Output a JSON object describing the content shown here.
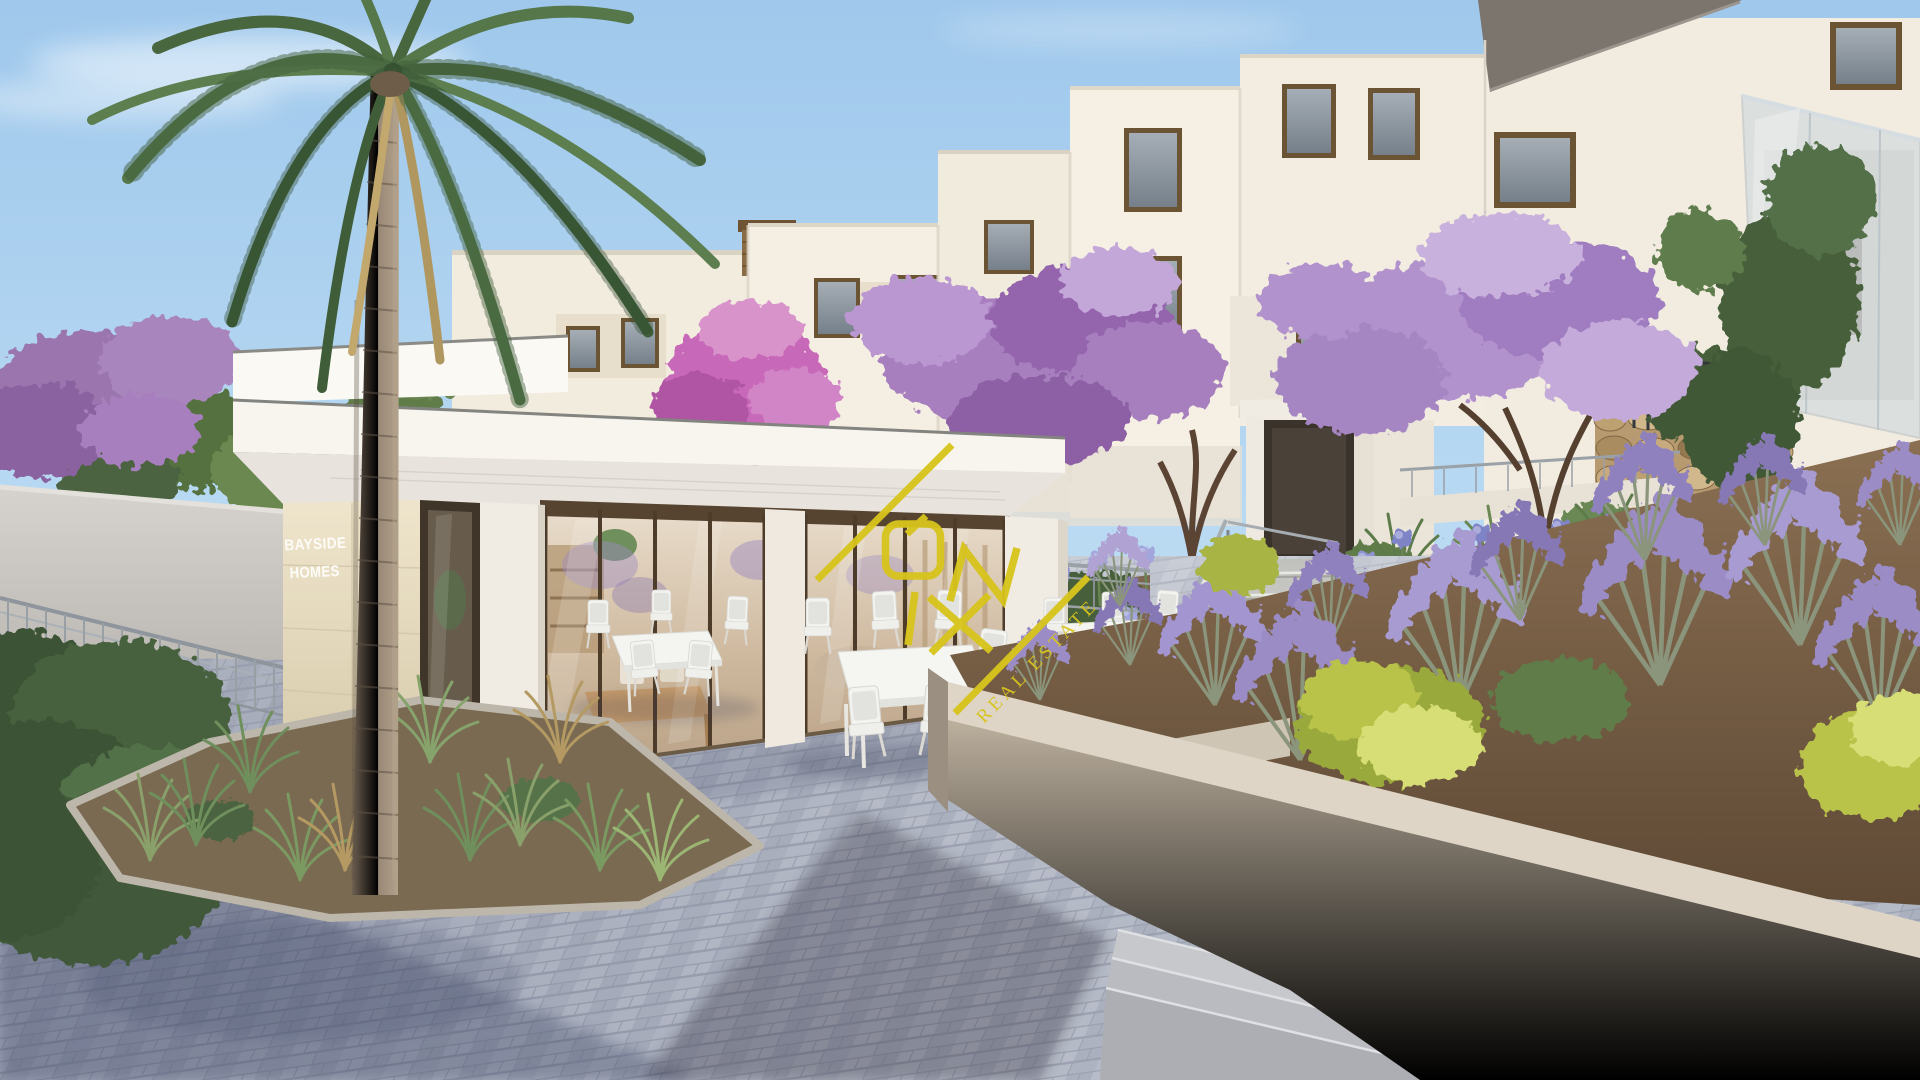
{
  "signage": {
    "line1": "BAYSIDE",
    "line2": "HOMES"
  },
  "watermark": {
    "brand": "ÓNIX",
    "tagline": "REAL ESTATE",
    "color": "#d7c41d"
  },
  "palette": {
    "sky_top": "#9fc8ec",
    "sky_horizon": "#d8ecf8",
    "building_sunlit": "#f6f0e4",
    "building_shade": "#e3dccf",
    "canopy_white": "#faf8f2",
    "sign_wall": "#e9dec3",
    "sign_text": "#fdfcf8",
    "window_frame": "#6b5433",
    "glass_door_frame": "#4e3c2a",
    "paving": "#aeb4c1",
    "paving_shadow": "#8b91a3",
    "planter_wall": "#b5a997",
    "soil": "#7d6750",
    "lavender": "#9b8cc6",
    "agapanthus": "#8f93d0",
    "jacaranda_purple": "#a77fbe",
    "magenta_tree": "#c867b8",
    "palm_green": "#55774a",
    "dry_frond": "#b0975f",
    "stone_wall": "#b79a6f",
    "stairs": "#d8d8d4",
    "railing": "#9aa1a7",
    "furniture_white": "#f3f3f0",
    "bike_black": "#3a3f45",
    "bike_pink": "#e6c0c9"
  }
}
